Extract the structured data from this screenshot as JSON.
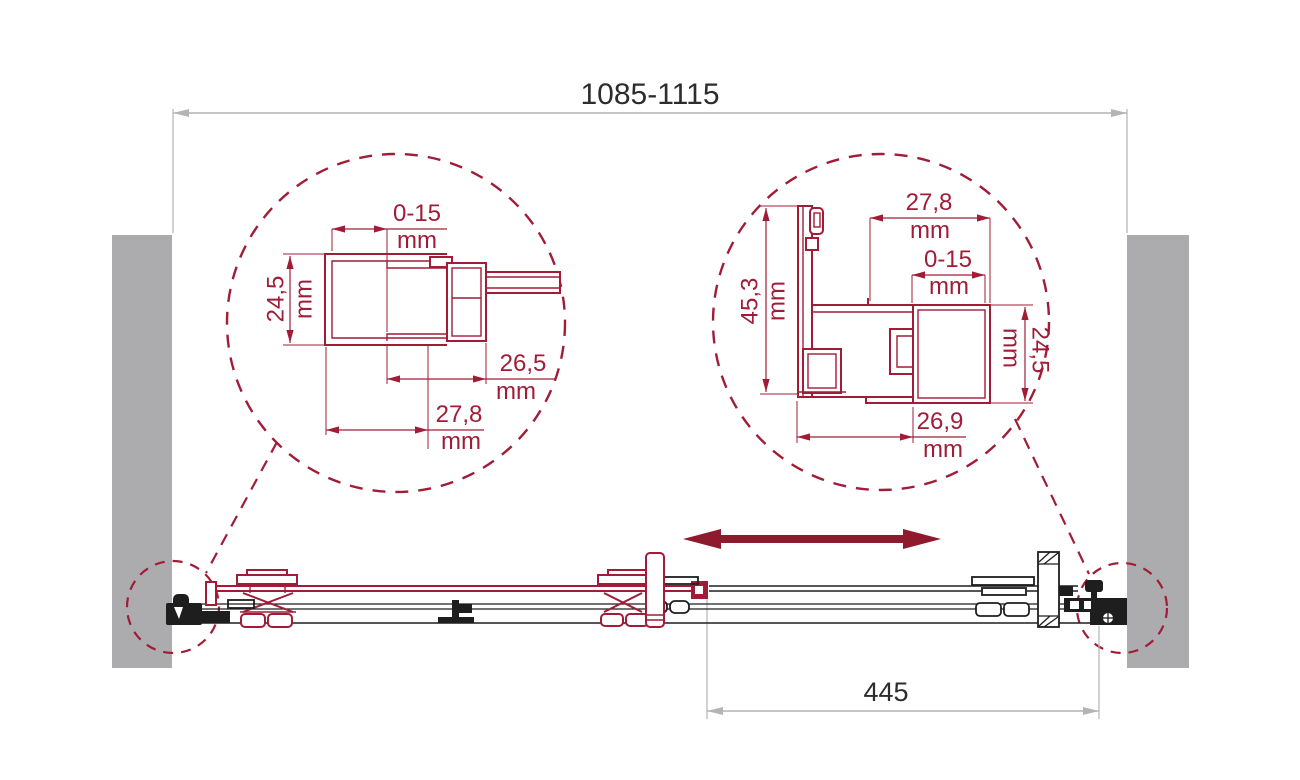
{
  "colors": {
    "accent": "#A11C37",
    "arrow": "#8E1A2D",
    "wall": "#ACACAE",
    "dim": "#B4B4B7",
    "ink": "#2D2D2D",
    "line": "#1E1E1E",
    "bg": "#FFFFFF"
  },
  "overall_width": {
    "label": "1085-1115"
  },
  "opening_width": {
    "label": "445"
  },
  "left_detail": {
    "dim_0_15": {
      "value": "0-15",
      "unit": "mm"
    },
    "dim_24_5": {
      "value": "24,5",
      "unit": "mm"
    },
    "dim_26_5": {
      "value": "26,5",
      "unit": "mm"
    },
    "dim_27_8": {
      "value": "27,8",
      "unit": "mm"
    }
  },
  "right_detail": {
    "dim_27_8": {
      "value": "27,8",
      "unit": "mm"
    },
    "dim_0_15": {
      "value": "0-15",
      "unit": "mm"
    },
    "dim_45_3": {
      "value": "45,3",
      "unit": "mm"
    },
    "dim_24_5": {
      "value": "24,5",
      "unit": "mm"
    },
    "dim_26_9": {
      "value": "26,9",
      "unit": "mm"
    }
  }
}
